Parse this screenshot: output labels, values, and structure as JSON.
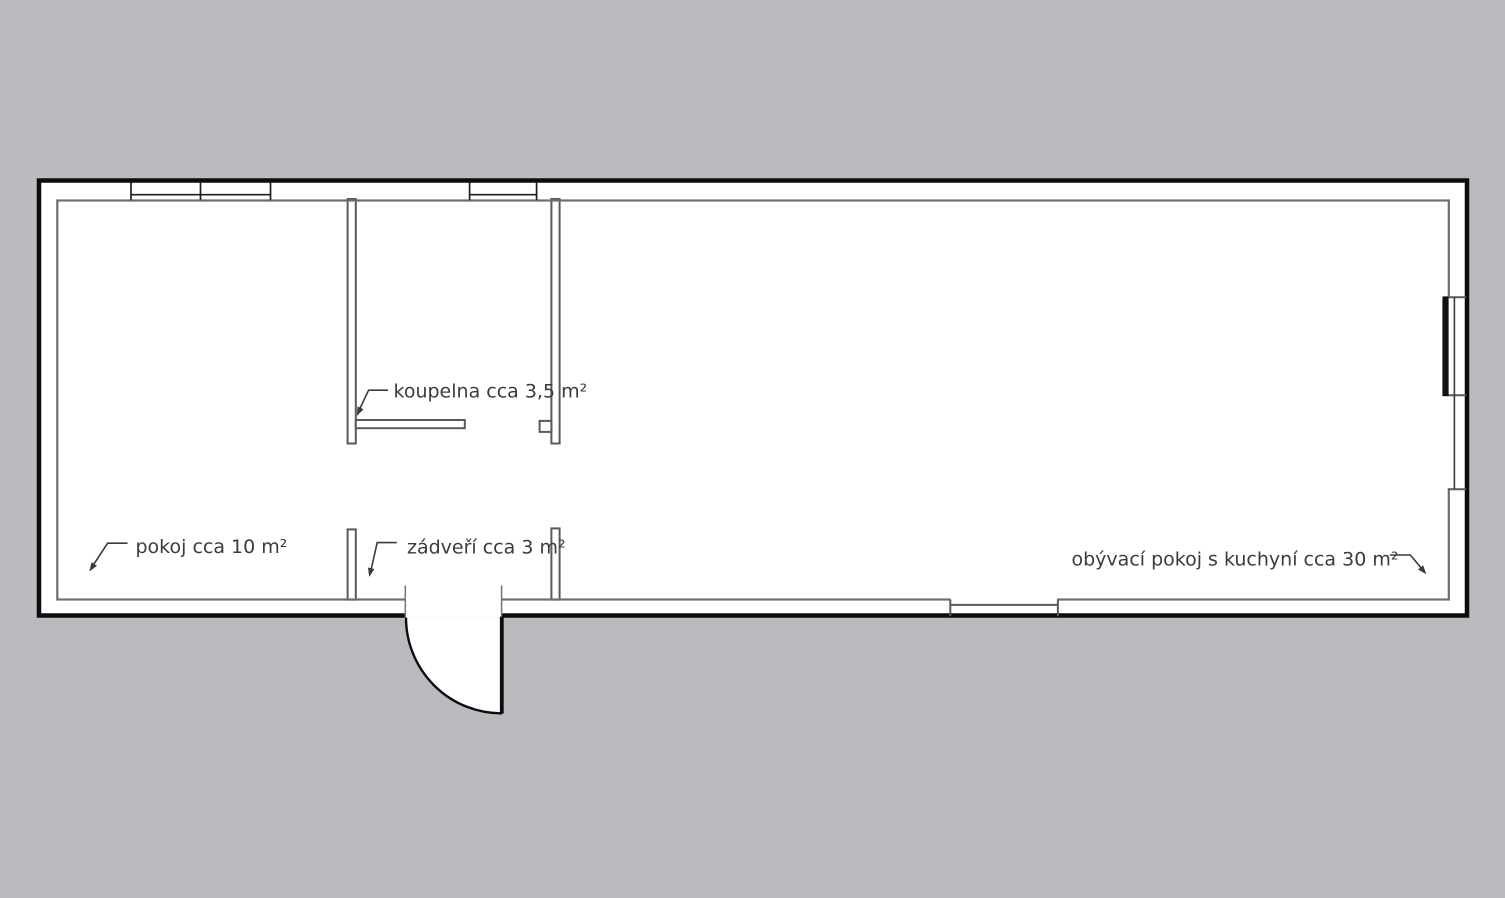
{
  "plan": {
    "title": "floor-plan",
    "rooms": [
      {
        "id": "pokoj",
        "label": "pokoj cca 10 m²"
      },
      {
        "id": "koupelna",
        "label": "koupelna cca 3,5 m²"
      },
      {
        "id": "zadveri",
        "label": "zádveří cca 3 m²"
      },
      {
        "id": "obyvaci-pokoj",
        "label": "obývací pokoj s kuchyní cca 30 m²"
      }
    ]
  },
  "colors": {
    "background": "#babbbf",
    "floor": "#ffffff",
    "outer_wall_outline": "#0d0d0d",
    "inner_wall_line": "#6d6d72",
    "partition_line": "#5a5a5e",
    "label_text": "#3b3b3b",
    "door_leaf": "#121212"
  }
}
